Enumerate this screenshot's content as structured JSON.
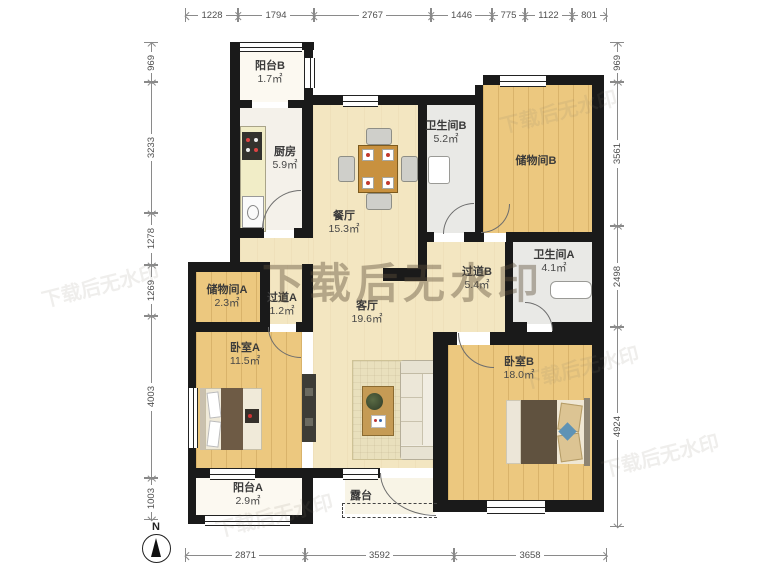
{
  "plan": {
    "title": "户型图",
    "north_label": "N",
    "watermark": "下载后无水印",
    "rooms": [
      {
        "name": "阳台B",
        "area": "1.7㎡"
      },
      {
        "name": "厨房",
        "area": "5.9㎡"
      },
      {
        "name": "餐厅",
        "area": "15.3㎡"
      },
      {
        "name": "卫生间B",
        "area": "5.2㎡"
      },
      {
        "name": "储物间B",
        "area": ""
      },
      {
        "name": "卫生间A",
        "area": "4.1㎡"
      },
      {
        "name": "过道B",
        "area": "5.4㎡"
      },
      {
        "name": "储物间A",
        "area": "2.3㎡"
      },
      {
        "name": "过道A",
        "area": "1.2㎡"
      },
      {
        "name": "客厅",
        "area": "19.6㎡"
      },
      {
        "name": "卧室A",
        "area": "11.5㎡"
      },
      {
        "name": "卧室B",
        "area": "18.0㎡"
      },
      {
        "name": "阳台A",
        "area": "2.9㎡"
      },
      {
        "name": "露台",
        "area": ""
      }
    ],
    "dimensions": {
      "top": [
        "1228",
        "1794",
        "2767",
        "1446",
        "775",
        "1122",
        "801"
      ],
      "bottom": [
        "2871",
        "3592",
        "3658"
      ],
      "left": [
        "969",
        "3233",
        "1278",
        "1269",
        "4003",
        "1003"
      ],
      "right": [
        "969",
        "3561",
        "2498",
        "4924"
      ]
    }
  }
}
